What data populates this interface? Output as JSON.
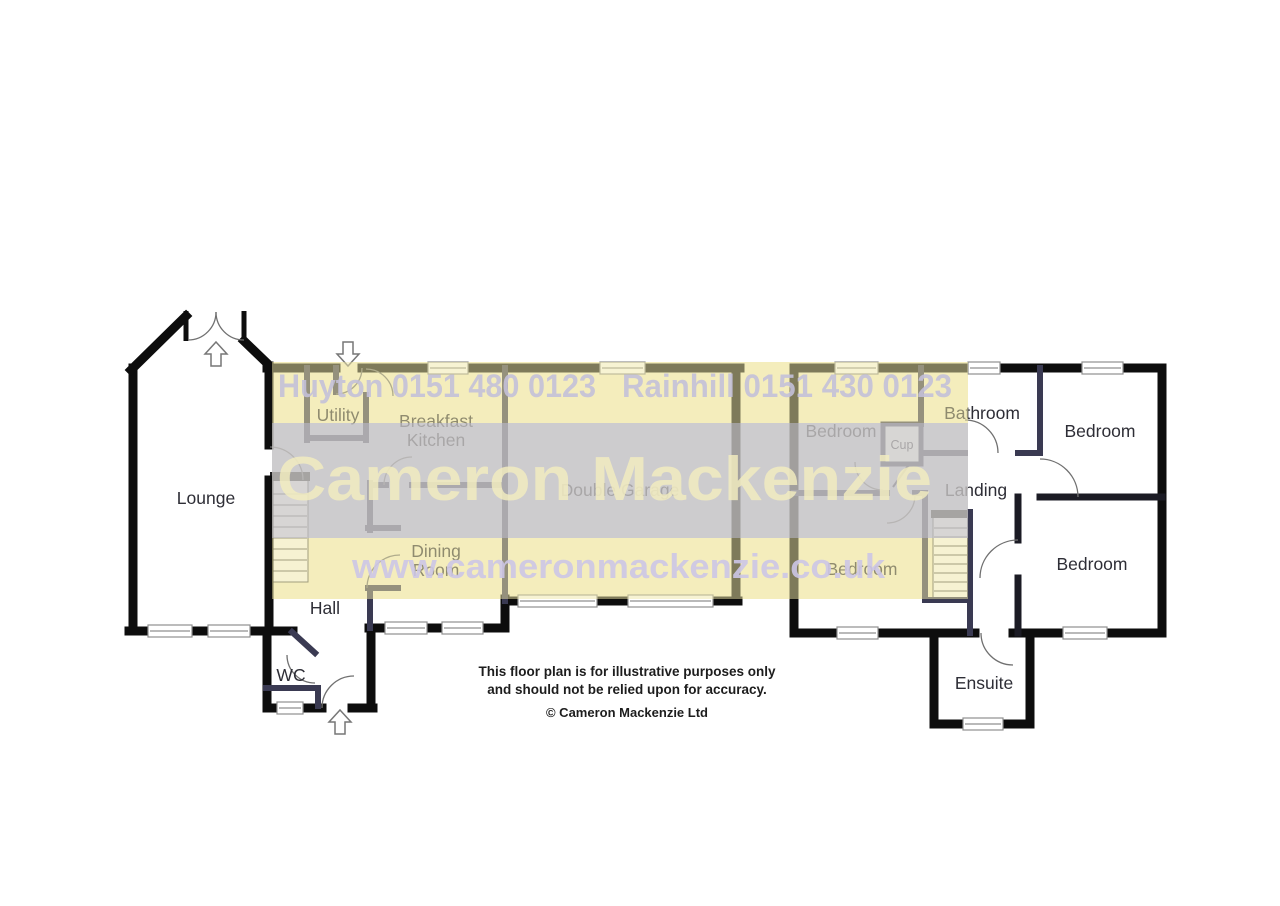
{
  "floorplan": {
    "rooms": {
      "lounge": "Lounge",
      "utility": "Utility",
      "breakfast_kitchen_line1": "Breakfast",
      "breakfast_kitchen_line2": "Kitchen",
      "dining_room_line1": "Dining",
      "dining_room_line2": "Room",
      "hall": "Hall",
      "wc": "WC",
      "double_garage": "Double Garage",
      "bedroom_top_left": "Bedroom",
      "cup": "Cup",
      "bathroom": "Bathroom",
      "bedroom_top_right": "Bedroom",
      "landing": "Landing",
      "bedroom_bottom_left": "Bedroom",
      "bedroom_bottom_right": "Bedroom",
      "ensuite": "Ensuite"
    },
    "watermark": {
      "office1": "Huyton 0151 480 0123",
      "office2": "Rainhill 0151 430 0123",
      "brand": "Cameron Mackenzie",
      "website": "www.cameronmackenzie.co.uk",
      "band_yellow": "#f8f3d0",
      "band_lavender": "#d3d3e3",
      "text_on_yellow": "#c3c0d8",
      "text_on_lavender": "#f3edc0",
      "website_color": "#ccc5e5"
    },
    "disclaimer": {
      "line1": "This floor plan is for illustrative purposes only",
      "line2": "and should not be relied upon for accuracy.",
      "copyright": "© Cameron Mackenzie Ltd"
    }
  }
}
